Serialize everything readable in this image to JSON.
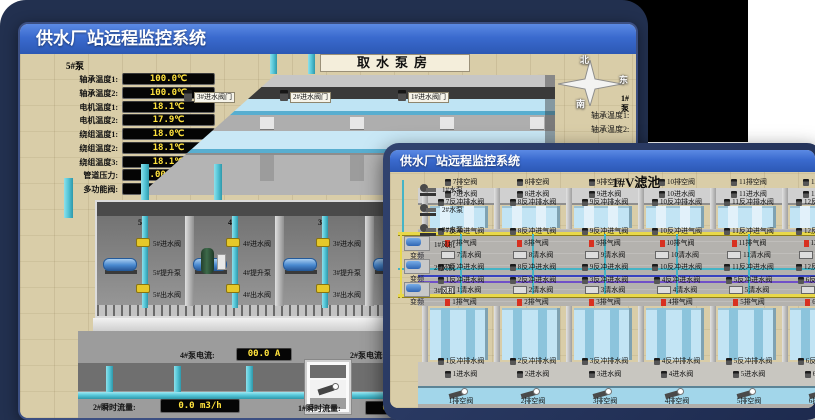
{
  "back_window": {
    "title": "供水厂站远程监控系统",
    "room_label": "取水泵房",
    "pump_panel": {
      "header": "5#泵",
      "rows": [
        {
          "label": "轴承温度1:",
          "value": "100.0℃"
        },
        {
          "label": "轴承温度2:",
          "value": "100.0℃"
        },
        {
          "label": "电机温度1:",
          "value": "18.1℃"
        },
        {
          "label": "电机温度2:",
          "value": "17.9℃"
        },
        {
          "label": "绕组温度1:",
          "value": "18.0℃"
        },
        {
          "label": "绕组温度2:",
          "value": "18.1℃"
        },
        {
          "label": "绕组温度3:",
          "value": "18.1℃"
        },
        {
          "label": "管道压力:",
          "value": "0.0007MPa"
        },
        {
          "label": "多功能阀:",
          "value": "0%"
        }
      ]
    },
    "intake_valves": [
      "3#进水阀门",
      "2#进水阀门",
      "1#进水阀门"
    ],
    "compass": {
      "north": "北",
      "south": "南",
      "west": "西",
      "east": "东"
    },
    "side_panel": {
      "header": "1#泵",
      "rows": [
        "轴承温度1:",
        "轴承温度2:"
      ]
    },
    "pump_bays": [
      {
        "name": "5#",
        "inlet_valve": "5#进水阀",
        "pump": "5#提升泵",
        "outlet_valve": "5#出水阀"
      },
      {
        "name": "4#",
        "inlet_valve": "4#进水阀",
        "pump": "4#提升泵",
        "outlet_valve": "4#出水阀"
      },
      {
        "name": "3#",
        "inlet_valve": "3#进水阀",
        "pump": "3#提升泵",
        "outlet_valve": "3#出水阀"
      },
      {
        "name": "2#",
        "inlet_valve": "2#进水阀",
        "pump": "2#提升泵",
        "outlet_valve": "2#出水阀"
      }
    ],
    "current_readouts": [
      {
        "label": "4#泵电流:",
        "value": "00.0 A"
      },
      {
        "label": "2#泵电流:",
        "value": ""
      }
    ],
    "flow_readouts": [
      {
        "label": "2#瞬时流量:",
        "value": "0.0 m3/h"
      },
      {
        "label": "1#瞬时流量:",
        "value": "0.0 m3/h"
      }
    ]
  },
  "front_window": {
    "title": "供水厂站远程监控系统",
    "pool_label": "1#V滤池",
    "water_pumps": [
      "1#水泵",
      "2#水泵",
      "3#水泵"
    ],
    "blowers": [
      {
        "name": "1#风机",
        "sub": "变频"
      },
      {
        "name": "2#风机",
        "sub": "变频"
      },
      {
        "name": "3#风机",
        "sub": "变频"
      }
    ],
    "top_cells": [
      7,
      8,
      9,
      10,
      11,
      12
    ],
    "bottom_cells": [
      1,
      2,
      3,
      4,
      5,
      6
    ],
    "valve_names": {
      "drain": "排空阀",
      "inlet": "进水阀",
      "backwash_drain": "反冲排水阀",
      "backwash_air": "反冲进气阀",
      "exhaust": "排气阀",
      "clean": "清水阀",
      "backwash_water": "反冲进水阀"
    }
  },
  "colors": {
    "titlebar_blue": "#3a6ace",
    "pipe_cyan": "#57c8da",
    "valve_yellow": "#e6c829",
    "alarm_red": "#d83020",
    "led_text": "#ffe23d",
    "ground_tan": "#d9cda8"
  }
}
